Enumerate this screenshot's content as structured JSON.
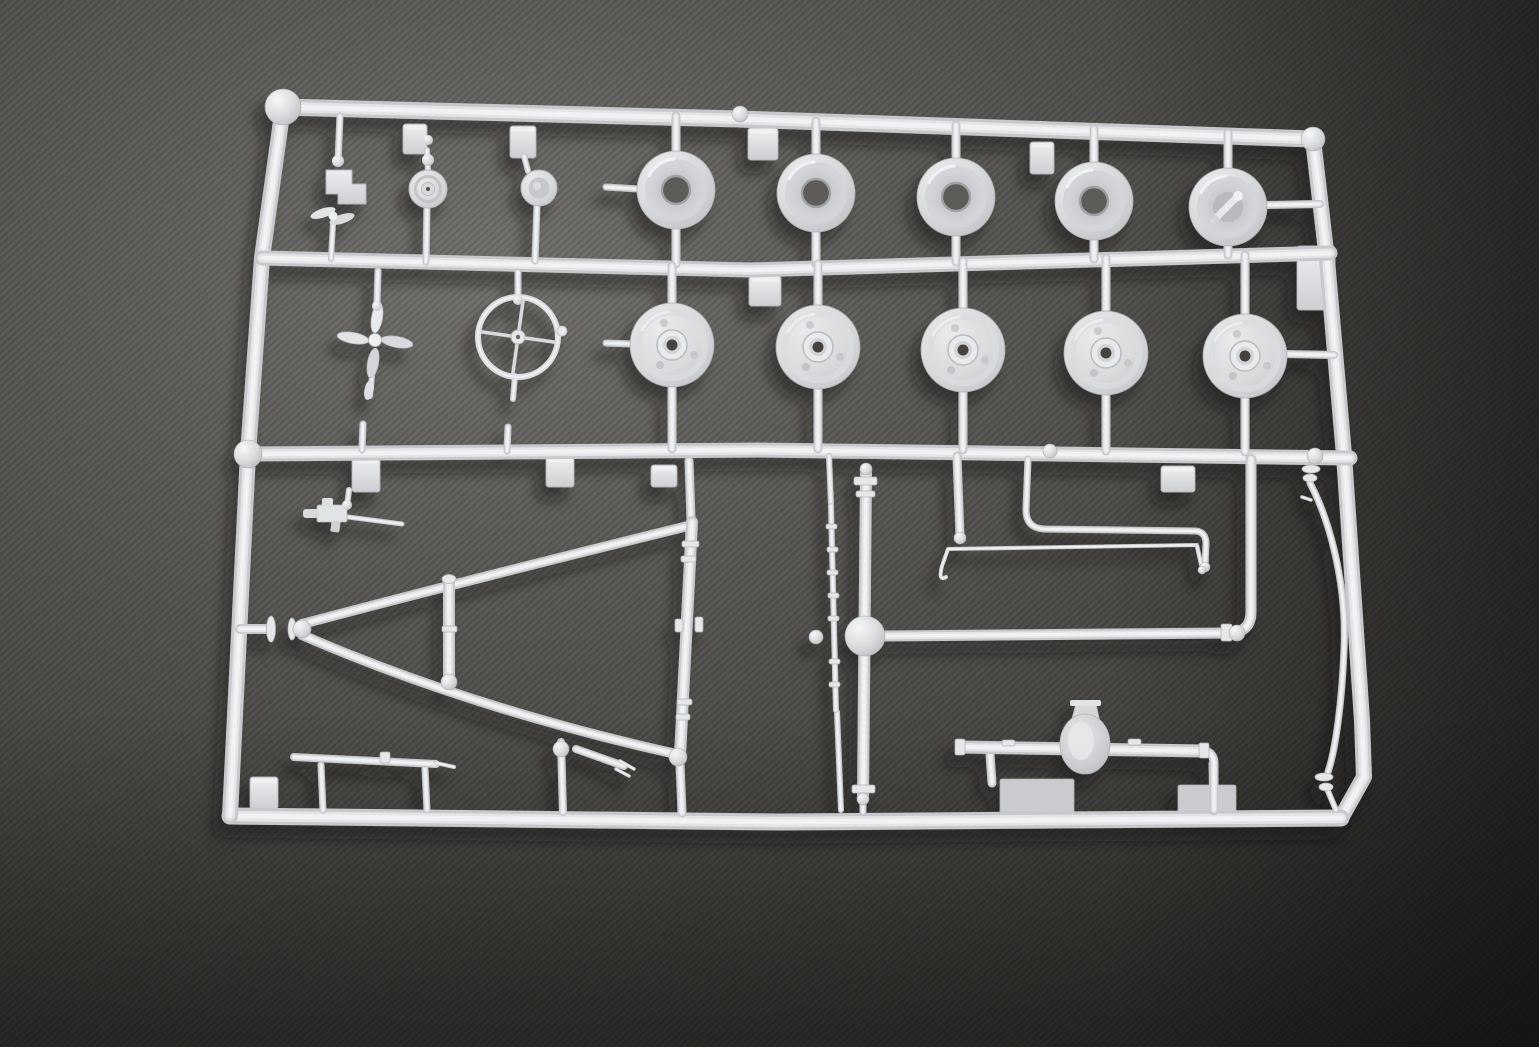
{
  "scene": {
    "subject": "white polystyrene model kit sprue (parts tree) photographed on dark gray fabric",
    "background_fabric": {
      "light": "#787672",
      "base": "#4e4c49",
      "dark": "#373532",
      "darkest": "#292826"
    },
    "plastic": {
      "base": "#c6c8cc",
      "mid": "#e2e4e6",
      "highlight": "#f4f5f7",
      "shaded": "#b2b4b8",
      "hole_dark": "#454340",
      "rim_hole": "#5d5c59",
      "cast_shadow": "#16150f"
    },
    "parts_inventory": [
      {
        "name": "wheel-rim",
        "qty": 5
      },
      {
        "name": "wheel-rim-with-crank",
        "qty": 1
      },
      {
        "name": "wheel-hub-disc",
        "qty": 5
      },
      {
        "name": "steering-wheel",
        "qty": 1
      },
      {
        "name": "four-blade-fan",
        "qty": 1
      },
      {
        "name": "two-blade-propeller",
        "qty": 1
      },
      {
        "name": "engine-bracket",
        "qty": 1
      },
      {
        "name": "pulley-cap",
        "qty": 1
      },
      {
        "name": "recessed-cap",
        "qty": 1
      },
      {
        "name": "machine-gun",
        "qty": 1
      },
      {
        "name": "a-frame-tow-bar",
        "qty": 1
      },
      {
        "name": "suspension-strut",
        "qty": 1
      },
      {
        "name": "forked-link",
        "qty": 1
      },
      {
        "name": "stepped-rod",
        "qty": 1
      },
      {
        "name": "axle-with-kingpin",
        "qty": 1
      },
      {
        "name": "leaf-spring-rod",
        "qty": 1
      },
      {
        "name": "tie-rod",
        "qty": 2
      },
      {
        "name": "rear-axle-housing",
        "qty": 1
      },
      {
        "name": "curved-exhaust-pipe",
        "qty": 1
      },
      {
        "name": "gate-tab",
        "qty": 11
      },
      {
        "name": "molded-plate",
        "qty": 2
      }
    ]
  },
  "sprue": {
    "runs": [
      {
        "n": "frame-top-rail",
        "d": "M283,107 L740,119 L1313,139",
        "w": 17
      },
      {
        "n": "frame-right-rail",
        "d": "M1313,139 L1327,260 L1344,455 L1362,720 L1364,777 L1341,818",
        "w": 16
      },
      {
        "n": "frame-bottom-rail",
        "d": "M1341,818 L780,822 L230,816",
        "w": 17
      },
      {
        "n": "frame-left-rail",
        "d": "M283,107 L262,258 L248,454 L230,816",
        "w": 16
      },
      {
        "n": "frame-mid-rail-upper",
        "d": "M262,258 L750,270 L1330,253",
        "w": 15
      },
      {
        "n": "frame-mid-rail-lower",
        "d": "M248,454 L760,450 L1350,458",
        "w": 15
      },
      {
        "n": "axle-arm-runner",
        "d": "M1251,459 L1251,612 Q1251,632 1230,633",
        "w": 11
      },
      {
        "n": "runner-stub",
        "d": "M676,116 L676,155",
        "w": 9
      },
      {
        "n": "runner-stub",
        "d": "M816,121 L816,158",
        "w": 9
      },
      {
        "n": "runner-stub",
        "d": "M956,125 L956,162",
        "w": 9
      },
      {
        "n": "runner-stub",
        "d": "M1094,129 L1094,166",
        "w": 9
      },
      {
        "n": "runner-stub",
        "d": "M1228,133 L1228,172",
        "w": 9
      },
      {
        "n": "runner-stub",
        "d": "M676,224 L676,264",
        "w": 9
      },
      {
        "n": "runner-stub",
        "d": "M816,227 L816,264",
        "w": 9
      },
      {
        "n": "runner-stub",
        "d": "M956,231 L956,262",
        "w": 9
      },
      {
        "n": "runner-stub",
        "d": "M1094,235 L1094,259",
        "w": 9
      },
      {
        "n": "runner-stub",
        "d": "M1228,241 L1228,255",
        "w": 9
      },
      {
        "n": "runner-stub",
        "d": "M639,189 L606,187",
        "w": 7
      },
      {
        "n": "runner-stub",
        "d": "M1266,205 L1320,204",
        "w": 8
      },
      {
        "n": "runner-stub",
        "d": "M672,305 L672,266",
        "w": 9
      },
      {
        "n": "runner-stub",
        "d": "M818,307 L818,264",
        "w": 9
      },
      {
        "n": "runner-stub",
        "d": "M963,310 L963,261",
        "w": 9
      },
      {
        "n": "runner-stub",
        "d": "M1106,313 L1106,258",
        "w": 9
      },
      {
        "n": "runner-stub",
        "d": "M1245,316 L1245,255",
        "w": 9
      },
      {
        "n": "runner-stub",
        "d": "M672,385 L672,449",
        "w": 9
      },
      {
        "n": "runner-stub",
        "d": "M818,387 L818,449",
        "w": 9
      },
      {
        "n": "runner-stub",
        "d": "M963,390 L963,450",
        "w": 9
      },
      {
        "n": "runner-stub",
        "d": "M1106,393 L1106,451",
        "w": 9
      },
      {
        "n": "runner-stub",
        "d": "M1245,396 L1245,452",
        "w": 9
      },
      {
        "n": "runner-stub",
        "d": "M632,344 L606,343",
        "w": 7
      },
      {
        "n": "runner-stub",
        "d": "M1286,354 L1334,355",
        "w": 8
      },
      {
        "n": "runner-stub",
        "d": "M340,116 L338,162",
        "w": 7
      },
      {
        "n": "runner-stub",
        "d": "M333,224 L331,259",
        "w": 6
      },
      {
        "n": "runner-stub",
        "d": "M427,150 L428,171",
        "w": 6
      },
      {
        "n": "runner-stub",
        "d": "M427,207 L426,262",
        "w": 7
      },
      {
        "n": "runner-stub",
        "d": "M524,156 L528,171",
        "w": 6
      },
      {
        "n": "runner-stub",
        "d": "M537,206 L535,261",
        "w": 7
      },
      {
        "n": "runner-stub",
        "d": "M378,271 L377,303",
        "w": 7
      },
      {
        "n": "runner-stub",
        "d": "M372,376 L370,396",
        "w": 6
      },
      {
        "n": "runner-stub",
        "d": "M363,424 L362,450",
        "w": 7
      },
      {
        "n": "runner-stub",
        "d": "M518,272 L518,298",
        "w": 7
      },
      {
        "n": "runner-stub",
        "d": "M515,376 L513,399",
        "w": 6
      },
      {
        "n": "runner-stub",
        "d": "M508,427 L507,451",
        "w": 7
      },
      {
        "n": "runner-stub",
        "d": "M349,490 L347,506",
        "w": 6
      },
      {
        "n": "runner-stub",
        "d": "M689,461 L691,519",
        "w": 9
      },
      {
        "n": "runner-stub",
        "d": "M680,763 L682,813",
        "w": 9
      },
      {
        "n": "runner-stub",
        "d": "M240,629 L267,629",
        "w": 10
      },
      {
        "n": "runner-stub",
        "d": "M561,742 L563,812",
        "w": 8
      },
      {
        "n": "runner-stub",
        "d": "M829,456 L831,504",
        "w": 6
      },
      {
        "n": "runner-stub",
        "d": "M837,712 L841,810",
        "w": 6
      },
      {
        "n": "runner-stub",
        "d": "M863,797 L863,812",
        "w": 7
      },
      {
        "n": "runner-stub",
        "d": "M957,456 L960,536",
        "w": 9
      },
      {
        "n": "runner-stub",
        "d": "M990,754 L992,783",
        "w": 9
      },
      {
        "n": "runner-stub",
        "d": "M1213,764 L1214,811",
        "w": 9
      },
      {
        "n": "runner-stub",
        "d": "M1328,791 L1336,810",
        "w": 6
      },
      {
        "n": "runner-stub",
        "d": "M321,765 L323,810",
        "w": 7
      },
      {
        "n": "runner-stub",
        "d": "M425,769 L427,810",
        "w": 7
      },
      {
        "n": "towbar-upper-arm",
        "d": "M302,624 Q480,577 688,526",
        "w": 10
      },
      {
        "n": "towbar-lower-arm",
        "d": "M302,635 Q470,708 676,754",
        "w": 10
      },
      {
        "n": "towbar-right-bar",
        "d": "M692,522 L680,756",
        "w": 12
      },
      {
        "n": "suspension-strut",
        "d": "M449,580 L449,684",
        "w": 12
      },
      {
        "n": "forked-link",
        "d": "M576,749 L624,766",
        "w": 8
      },
      {
        "n": "forked-link-prong",
        "d": "M620,761 L634,769",
        "w": 3.5
      },
      {
        "n": "forked-link-prong",
        "d": "M616,769 L629,776",
        "w": 3.5
      },
      {
        "n": "stepped-rod",
        "d": "M294,757 L436,764",
        "w": 8
      },
      {
        "n": "stepped-rod-tip",
        "d": "M436,763 L454,767",
        "w": 4
      },
      {
        "n": "gun-barrel",
        "d": "M348,517 L402,524",
        "w": 5
      },
      {
        "n": "axle-vertical-shaft",
        "d": "M866,474 L863,799",
        "w": 12
      },
      {
        "n": "axle-horizontal-arm",
        "d": "M884,636 L1228,633",
        "w": 11
      },
      {
        "n": "leaf-spring-rod",
        "d": "M831,506 L836,710",
        "w": 6
      },
      {
        "n": "tie-rod-upper",
        "d": "M1028,459 L1026,510 Q1026,528 1044,529 L1196,531 Q1206,532 1206,544 L1205,566",
        "w": 7
      },
      {
        "n": "tie-rod-lower",
        "d": "M946,577 Q938,582 942,566 L948,549 L1197,545",
        "w": 4
      },
      {
        "n": "tie-rod-lower-foot",
        "d": "M1197,546 L1202,568",
        "w": 4.5
      },
      {
        "n": "rear-axle-beam",
        "d": "M962,747 L1204,751",
        "w": 13
      },
      {
        "n": "rear-axle-elbow",
        "d": "M1204,751 Q1213,752 1214,762 L1214,810",
        "w": 9
      },
      {
        "n": "curved-exhaust-pipe",
        "d": "M1310,483 C1332,525 1347,590 1344,650 C1342,700 1336,748 1328,772",
        "w": 7
      },
      {
        "n": "pipe-nub",
        "d": "M1302,497 L1311,500",
        "w": 3.5
      }
    ],
    "collars": [
      [
        682,
        541,
        17,
        6
      ],
      [
        681,
        556,
        15,
        6
      ],
      [
        675,
        619,
        8,
        13
      ],
      [
        695,
        617,
        8,
        15
      ],
      [
        677,
        699,
        15,
        6
      ],
      [
        676,
        714,
        14,
        6
      ],
      [
        442,
        626,
        15,
        6
      ],
      [
        826,
        524,
        11,
        5
      ],
      [
        827,
        547,
        11,
        5
      ],
      [
        827,
        570,
        11,
        5
      ],
      [
        828,
        593,
        11,
        5
      ],
      [
        828,
        616,
        11,
        5
      ],
      [
        829,
        659,
        11,
        5
      ],
      [
        829,
        682,
        11,
        5
      ],
      [
        854,
        477,
        23,
        8
      ],
      [
        856,
        491,
        19,
        6
      ],
      [
        852,
        785,
        23,
        8
      ],
      [
        1221,
        624,
        11,
        17
      ],
      [
        380,
        752,
        10,
        11
      ],
      [
        1002,
        740,
        13,
        6
      ],
      [
        1128,
        739,
        13,
        6
      ],
      [
        955,
        739,
        10,
        16
      ],
      [
        1199,
        743,
        10,
        15
      ]
    ],
    "flanges": [
      [
        271,
        629,
        4.5,
        13
      ],
      [
        292,
        629,
        4,
        11
      ],
      [
        1311,
        469,
        9,
        4
      ],
      [
        1310,
        478,
        7,
        4
      ],
      [
        1324,
        777,
        9,
        4
      ],
      [
        1326,
        787,
        7,
        4
      ],
      [
        449,
        579,
        7,
        4.5
      ]
    ],
    "balls": [
      [
        283,
        107,
        18
      ],
      [
        740,
        114,
        8
      ],
      [
        1313,
        139,
        12
      ],
      [
        248,
        454,
        14
      ],
      [
        1050,
        451,
        7
      ],
      [
        1315,
        456,
        8
      ],
      [
        302,
        629,
        9
      ],
      [
        678,
        757,
        9
      ],
      [
        449,
        682,
        8
      ],
      [
        865,
        636,
        20
      ],
      [
        816,
        637,
        7
      ],
      [
        960,
        538,
        6
      ],
      [
        1205,
        567,
        5
      ],
      [
        1202,
        570,
        4
      ],
      [
        1237,
        633,
        8
      ],
      [
        866,
        469,
        6
      ],
      [
        863,
        799,
        6
      ],
      [
        561,
        749,
        8
      ]
    ],
    "beads": [
      [
        338,
        161,
        6
      ],
      [
        428,
        140,
        5
      ],
      [
        428,
        160,
        6
      ],
      [
        377,
        306,
        5
      ],
      [
        518,
        300,
        5
      ],
      [
        347,
        505,
        5
      ]
    ],
    "tabs": [
      [
        403,
        124,
        24,
        30
      ],
      [
        510,
        126,
        26,
        32
      ],
      [
        748,
        128,
        30,
        32
      ],
      [
        1030,
        142,
        24,
        32
      ],
      [
        1297,
        246,
        38,
        64
      ],
      [
        749,
        276,
        32,
        30
      ],
      [
        352,
        458,
        28,
        34
      ],
      [
        546,
        457,
        28,
        30
      ],
      [
        651,
        465,
        26,
        22
      ],
      [
        1161,
        466,
        34,
        26
      ],
      [
        250,
        777,
        28,
        32
      ]
    ],
    "plates": [
      [
        1000,
        779,
        74,
        37
      ],
      [
        1178,
        785,
        58,
        30
      ]
    ],
    "wheel_rims": [
      [
        676,
        190,
        0
      ],
      [
        816,
        193,
        0
      ],
      [
        956,
        197,
        0
      ],
      [
        1094,
        201,
        0
      ],
      [
        1228,
        207,
        1
      ]
    ],
    "wheel_discs": [
      [
        672,
        345
      ],
      [
        818,
        347
      ],
      [
        963,
        350
      ],
      [
        1106,
        353
      ],
      [
        1245,
        356
      ]
    ]
  }
}
